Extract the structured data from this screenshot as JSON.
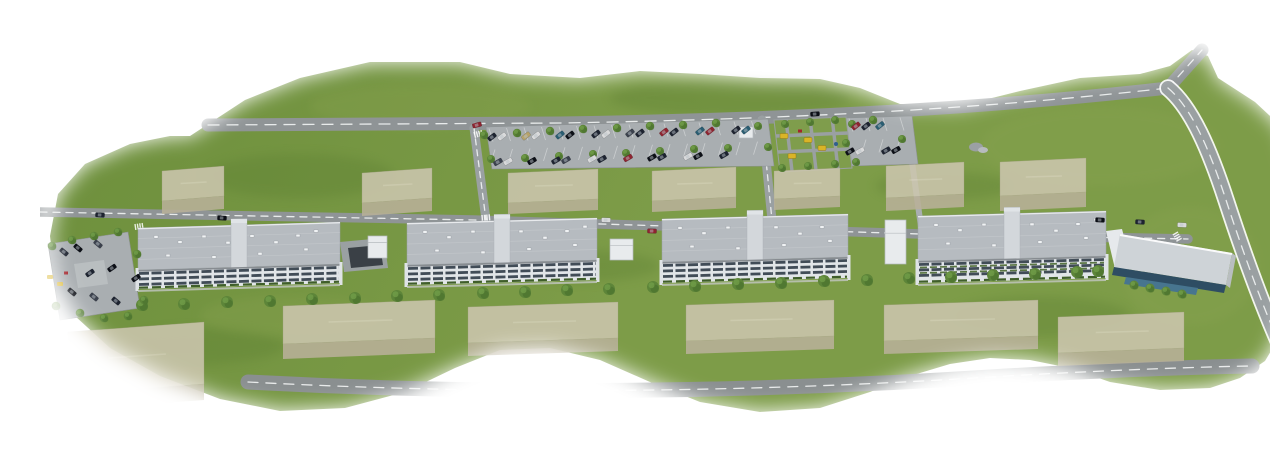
{
  "meta": {
    "title": "Residential complex aerial 3D render",
    "description": "Aerial 3D architectural rendering of a long residential development: a row of grey flat-roofed apartment blocks and a commercial building along an access road, roadside parking filled with cars, playgrounds, semi-transparent future-phase buildings and green lawns that fade into a white background."
  },
  "palette": {
    "grass1": "#6d8f3c",
    "grass2": "#7d9c48",
    "grassLight": "#8aa351",
    "grassDark": "#57792e",
    "road": "#8f9496",
    "roadDark": "#8a8f90",
    "roadMid": "#9aa0a2",
    "roadLight": "#a9aeb1",
    "line": "#f2f4f4",
    "island": "#b9bec0",
    "ghostTop": "#ccc6ae",
    "ghostFace": "#b9b199",
    "ghostEdge": "#a8a18a",
    "roof": "#b6bbc0",
    "roofEdge": "#9aa0a6",
    "core": "#d3d7db",
    "coreCap": "#e0e4e7",
    "hatch": "#f0f2f4",
    "facade": "#e1e5e8",
    "window": "#414c57",
    "endWall": "#dfe3e6",
    "shadow": "#1b222a",
    "hedge": "#3f5e2a",
    "terrace": "#4c6a33",
    "green1": "#466d2c",
    "green2": "#5d8539",
    "green3": "#719c49",
    "kiosk": "#e8ebed",
    "kioskEdge": "#b6bbbf",
    "rampDark": "#3a4046",
    "commercialRoof": "#ced3d7",
    "commercialWing": "#e6e9ec",
    "glass": "#2e4d63",
    "pool": "#47758f",
    "rockA": "#9ba0a4",
    "rockB": "#b7bbbe",
    "playYellow": "#d9b427",
    "playRed": "#a3252c",
    "playBlue": "#2f5f8e",
    "playLawn": "#7f9d4c",
    "sidewalk": "#c3c7c3",
    "white": "#ffffff"
  },
  "scene": {
    "canvas": {
      "w": 1270,
      "h": 435
    },
    "land": {
      "path": "M150,120L205,84L260,62L330,46L420,46L470,58L540,62L600,55L660,58L720,62L780,63L820,72L860,88L920,90L980,75L1040,62L1100,58L1130,50L1152,34L1168,40L1178,62L1215,86L1243,112L1256,150L1260,200L1256,250L1248,295L1234,330L1225,345L1200,362L1170,372L1120,374L1070,366L1030,352L990,344L950,342L910,348L870,360L830,376L780,392L720,396L660,386L610,366L560,344L510,332L460,334L415,352L365,376L305,392L240,395L180,383L120,360L70,332L35,300L15,262L10,220L18,178L45,148L90,128L130,120Z"
    },
    "patches": {
      "dark": [
        [
          260,
          160,
          95,
          22
        ],
        [
          690,
          82,
          120,
          18
        ],
        [
          1000,
          300,
          90,
          20
        ],
        [
          160,
          330,
          85,
          18
        ],
        [
          905,
          170,
          70,
          14
        ],
        [
          540,
          250,
          80,
          16
        ]
      ],
      "light": [
        [
          1060,
          130,
          120,
          40
        ],
        [
          380,
          90,
          110,
          22
        ],
        [
          1150,
          250,
          70,
          60
        ],
        [
          250,
          300,
          90,
          20
        ]
      ]
    },
    "roads": [
      {
        "name": "service-road",
        "d": "M0,196 L434,204 L880,218 L1148,223",
        "w": 9.5,
        "color": "road",
        "dash": "7 6"
      },
      {
        "name": "top-road",
        "d": "M168,109 L520,107 C760,103 950,92 1128,72",
        "w": 13,
        "color": "road",
        "dash": "11 8"
      },
      {
        "name": "top-road-stub",
        "d": "M1128,72 L1162,34",
        "w": 13,
        "color": "road",
        "dash": "8 7"
      },
      {
        "name": "east-road",
        "d": "M1128,72 C1152,92 1170,135 1186,184 C1202,233 1222,290 1244,338 L1252,358",
        "w": 14,
        "color": "roadMid",
        "dash": "9 7",
        "casing": true
      },
      {
        "name": "bottom-road",
        "d": "M208,366 C450,379 700,377 950,361 C1050,355 1150,351 1212,350",
        "w": 15,
        "color": "roadDark",
        "dash": "10 8"
      },
      {
        "name": "parking-entry-west",
        "d": "M434,112 L446,204",
        "w": 9,
        "color": "roadMid",
        "dash": "6 5"
      },
      {
        "name": "parking-entry-mid",
        "d": "M722,104 L732,204",
        "w": 9,
        "color": "roadMid",
        "dash": "6 5"
      },
      {
        "name": "footpath-east",
        "d": "M872,146 L882,218",
        "w": 6,
        "color": "roadLight"
      }
    ],
    "parking": {
      "lots": [
        {
          "name": "north-parking-strip",
          "points": "446,111 728,103 734,150 452,153"
        },
        {
          "name": "north-parking-east",
          "points": "806,102 872,100 878,148 812,150"
        },
        {
          "name": "west-parking-loop",
          "points": "8,228 88,216 100,292 20,304"
        }
      ],
      "island": "34,248 64,244 68,268 38,272",
      "stalls": [
        {
          "x0": 449,
          "y0": 112.5,
          "n": 16,
          "step": 17.5,
          "dx": 4,
          "dy": 13,
          "fall": -0.028
        },
        {
          "x0": 455,
          "y0": 133.5,
          "n": 16,
          "step": 17.5,
          "dx": -4,
          "dy": 13,
          "fall": -0.03
        },
        {
          "x0": 809,
          "y0": 102.5,
          "n": 4,
          "step": 17,
          "dx": 4,
          "dy": 13,
          "fall": -0.02
        },
        {
          "x0": 809,
          "y0": 124,
          "n": 4,
          "step": 17,
          "dx": -4,
          "dy": 13,
          "fall": -0.02
        }
      ]
    },
    "crosswalks": [
      {
        "x": 434,
        "y": 116,
        "rot": -15
      },
      {
        "x": 442,
        "y": 199,
        "rot": -5
      },
      {
        "x": 95,
        "y": 208,
        "rot": -8
      },
      {
        "x": 1138,
        "y": 216,
        "rot": 60
      }
    ],
    "playground_north": {
      "area": "734,104 806,101 812,152 740,156",
      "strips": [
        "M746,103 L752,155",
        "M770,102 L776,154",
        "M792,101 L798,153",
        "M736,120 L808,117",
        "M738,136 L810,133"
      ],
      "yellow": [
        [
          744,
          120
        ],
        [
          768,
          124
        ],
        [
          752,
          140
        ],
        [
          782,
          132
        ]
      ],
      "red": [
        [
          760,
          115
        ]
      ],
      "blue": [
        [
          796,
          128
        ]
      ]
    },
    "playground_west": {
      "yellow": [
        [
          10,
          261
        ],
        [
          20,
          268
        ]
      ],
      "red": [
        [
          26,
          257
        ]
      ]
    },
    "pavilion": {
      "x": 699,
      "y": 111,
      "w": 14,
      "h": 11
    },
    "rock": [
      [
        936,
        131,
        7,
        4.5
      ],
      [
        943,
        134,
        5,
        3
      ]
    ],
    "ghost": {
      "upper": [
        {
          "x": 122,
          "y": 150,
          "w": 62,
          "d": 30,
          "h": 13,
          "t": 5
        },
        {
          "x": 322,
          "y": 152,
          "w": 70,
          "d": 30,
          "h": 13,
          "t": 5
        },
        {
          "x": 468,
          "y": 153,
          "w": 90,
          "d": 30,
          "h": 11,
          "t": 4
        },
        {
          "x": 612,
          "y": 151,
          "w": 84,
          "d": 30,
          "h": 11,
          "t": 4
        },
        {
          "x": 734,
          "y": 152,
          "w": 66,
          "d": 28,
          "h": 11,
          "t": 3
        },
        {
          "x": 846,
          "y": 146,
          "w": 78,
          "d": 32,
          "h": 13,
          "t": 4
        },
        {
          "x": 960,
          "y": 142,
          "w": 86,
          "d": 34,
          "h": 15,
          "t": 4
        }
      ],
      "lower": [
        {
          "x": 243,
          "y": 284,
          "w": 152,
          "d": 38,
          "h": 15,
          "t": 6
        },
        {
          "x": 428,
          "y": 286,
          "w": 150,
          "d": 36,
          "h": 13,
          "t": 5
        },
        {
          "x": 646,
          "y": 284,
          "w": 148,
          "d": 36,
          "h": 13,
          "t": 5
        },
        {
          "x": 844,
          "y": 284,
          "w": 154,
          "d": 36,
          "h": 13,
          "t": 5
        },
        {
          "x": 1018,
          "y": 296,
          "w": 126,
          "d": 36,
          "h": 13,
          "t": 5
        }
      ],
      "big": {
        "x": 28,
        "y": 306,
        "w": 136,
        "d": 62,
        "h": 16,
        "t": 10
      }
    },
    "ramp": {
      "outer": "300,226 344,222 348,252 304,256",
      "inner": "308,232 340,229 343,249 311,252"
    },
    "kiosks": [
      {
        "x": 328,
        "y": 220,
        "w": 19,
        "h": 22
      },
      {
        "x": 570,
        "y": 223,
        "w": 23,
        "h": 21
      },
      {
        "x": 845,
        "y": 204,
        "w": 21,
        "h": 44
      }
    ],
    "hatch_offsets": [
      [
        16,
        8
      ],
      [
        40,
        14
      ],
      [
        64,
        9
      ],
      [
        88,
        16
      ],
      [
        112,
        10
      ],
      [
        136,
        17
      ],
      [
        158,
        11
      ],
      [
        176,
        7
      ],
      [
        28,
        27
      ],
      [
        74,
        30
      ],
      [
        120,
        28
      ],
      [
        166,
        25
      ]
    ],
    "blocks": [
      {
        "x": 98,
        "y": 212,
        "w": 202,
        "t": 6,
        "d": 42,
        "fh": 19,
        "terraced": false
      },
      {
        "x": 367,
        "y": 207,
        "w": 190,
        "t": 5,
        "d": 42,
        "fh": 20,
        "terraced": false
      },
      {
        "x": 622,
        "y": 203,
        "w": 186,
        "t": 5,
        "d": 43,
        "fh": 21,
        "terraced": false
      },
      {
        "x": 878,
        "y": 200,
        "w": 188,
        "t": 5,
        "d": 45,
        "fh": 22,
        "terraced": true
      }
    ],
    "commercial": {
      "parts": [
        {
          "name": "west-wing",
          "points": "1066,215 1082,213 1092,252 1076,257",
          "fill": "commercialWing"
        },
        {
          "name": "main-roof",
          "points": "1080,218 1192,237 1186,269 1074,251",
          "fill": "commercialRoof"
        },
        {
          "name": "east-wall",
          "points": "1186,269 1192,237 1196,240 1190,272",
          "fill": "island"
        },
        {
          "name": "glass-band",
          "points": "1074,251 1186,269 1184,277 1072,259",
          "fill": "glass"
        },
        {
          "name": "water-strip",
          "points": "1086,261 1158,272 1156,279 1084,268",
          "fill": "pool"
        }
      ],
      "ridge": {
        "x1": 1080,
        "y1": 219,
        "x2": 1192,
        "y2": 238
      }
    },
    "trees": {
      "parking_upper": {
        "r": 4.2,
        "pts": [
          [
            444,
            119
          ],
          [
            477,
            117
          ],
          [
            510,
            115
          ],
          [
            543,
            113
          ],
          [
            577,
            112
          ],
          [
            610,
            110
          ],
          [
            643,
            109
          ],
          [
            676,
            107
          ],
          [
            833,
            104
          ]
        ]
      },
      "parking_lower": {
        "r": 4,
        "pts": [
          [
            451,
            143
          ],
          [
            485,
            142
          ],
          [
            519,
            140
          ],
          [
            553,
            138
          ],
          [
            586,
            137
          ],
          [
            620,
            135
          ],
          [
            654,
            133
          ],
          [
            688,
            132
          ],
          [
            806,
            127
          ],
          [
            862,
            123
          ]
        ]
      },
      "south_row": {
        "r": 6,
        "pts": [
          [
            102,
            289
          ],
          [
            144,
            288
          ],
          [
            187,
            286
          ],
          [
            230,
            285
          ],
          [
            272,
            283
          ],
          [
            315,
            282
          ],
          [
            357,
            280
          ],
          [
            399,
            279
          ],
          [
            443,
            277
          ],
          [
            485,
            276
          ],
          [
            527,
            274
          ],
          [
            569,
            273
          ],
          [
            613,
            271
          ],
          [
            655,
            270
          ],
          [
            698,
            268
          ],
          [
            741,
            267
          ],
          [
            784,
            265
          ],
          [
            827,
            264
          ],
          [
            869,
            262
          ],
          [
            911,
            261
          ],
          [
            953,
            259
          ],
          [
            995,
            258
          ],
          [
            1037,
            256
          ],
          [
            1058,
            255
          ]
        ]
      },
      "loop": {
        "r": 4.3,
        "pts": [
          [
            12,
            230
          ],
          [
            32,
            224
          ],
          [
            54,
            220
          ],
          [
            78,
            216
          ],
          [
            97,
            238
          ],
          [
            16,
            290
          ],
          [
            40,
            297
          ],
          [
            64,
            302
          ],
          [
            88,
            300
          ],
          [
            104,
            284
          ]
        ]
      },
      "playground": {
        "r": 4,
        "pts": [
          [
            718,
            110
          ],
          [
            745,
            108
          ],
          [
            770,
            106
          ],
          [
            795,
            104
          ],
          [
            812,
            108
          ],
          [
            728,
            131
          ],
          [
            742,
            152
          ],
          [
            768,
            150
          ],
          [
            795,
            148
          ],
          [
            816,
            146
          ]
        ]
      },
      "commercial": {
        "r": 4.5,
        "pts": [
          [
            1094,
            269
          ],
          [
            1110,
            272
          ],
          [
            1126,
            275
          ],
          [
            1142,
            278
          ]
        ]
      }
    },
    "cars": {
      "colors": [
        "#1d2330",
        "#0c0f16",
        "#8e2430",
        "#d9dadb",
        "#2a5d72",
        "#b7a36b",
        "#3b414d"
      ],
      "parking_upper": {
        "angle": -38,
        "list": [
          [
            452,
            121,
            0
          ],
          [
            462,
            120.5,
            3
          ],
          [
            486,
            120,
            5
          ],
          [
            496,
            119.5,
            3
          ],
          [
            520,
            119,
            4
          ],
          [
            530,
            119,
            1
          ],
          [
            556,
            118,
            0
          ],
          [
            566,
            118,
            3
          ],
          [
            590,
            117,
            6
          ],
          [
            600,
            117,
            0
          ],
          [
            624,
            116,
            2
          ],
          [
            634,
            116,
            0
          ],
          [
            660,
            115,
            4
          ],
          [
            670,
            115,
            2
          ],
          [
            696,
            114,
            0
          ],
          [
            706,
            114,
            4
          ],
          [
            816,
            110,
            2
          ],
          [
            826,
            110,
            0
          ],
          [
            840,
            109.5,
            4
          ]
        ]
      },
      "parking_lower": {
        "angle": -30,
        "list": [
          [
            458,
            146,
            6
          ],
          [
            468,
            145.5,
            3
          ],
          [
            492,
            145,
            1
          ],
          [
            516,
            144.5,
            0
          ],
          [
            526,
            144,
            6
          ],
          [
            552,
            143,
            3
          ],
          [
            562,
            143,
            0
          ],
          [
            588,
            142,
            2
          ],
          [
            612,
            141.5,
            1
          ],
          [
            622,
            141,
            0
          ],
          [
            648,
            140.5,
            3
          ],
          [
            658,
            140,
            1
          ],
          [
            684,
            139,
            0
          ],
          [
            810,
            135.5,
            1
          ],
          [
            820,
            135,
            3
          ],
          [
            846,
            134.5,
            0
          ],
          [
            856,
            134,
            1
          ]
        ]
      },
      "loop": [
        [
          24,
          236,
          40,
          0
        ],
        [
          38,
          232,
          40,
          1
        ],
        [
          58,
          228,
          40,
          6
        ],
        [
          72,
          252,
          -35,
          1
        ],
        [
          50,
          257,
          -35,
          0
        ],
        [
          32,
          276,
          40,
          1
        ],
        [
          54,
          281,
          40,
          6
        ],
        [
          76,
          285,
          40,
          0
        ],
        [
          96,
          262,
          -35,
          1
        ]
      ],
      "road": [
        [
          775,
          98,
          -4,
          1
        ],
        [
          437,
          109,
          -15,
          2
        ],
        [
          566,
          204,
          2,
          3
        ],
        [
          612,
          215,
          2,
          2
        ],
        [
          1060,
          204,
          3,
          1
        ],
        [
          1100,
          206,
          3,
          0
        ],
        [
          1142,
          209,
          3,
          3
        ],
        [
          60,
          199,
          4,
          0
        ],
        [
          182,
          202,
          3,
          1
        ]
      ]
    },
    "feather": {
      "blur": 10
    }
  }
}
